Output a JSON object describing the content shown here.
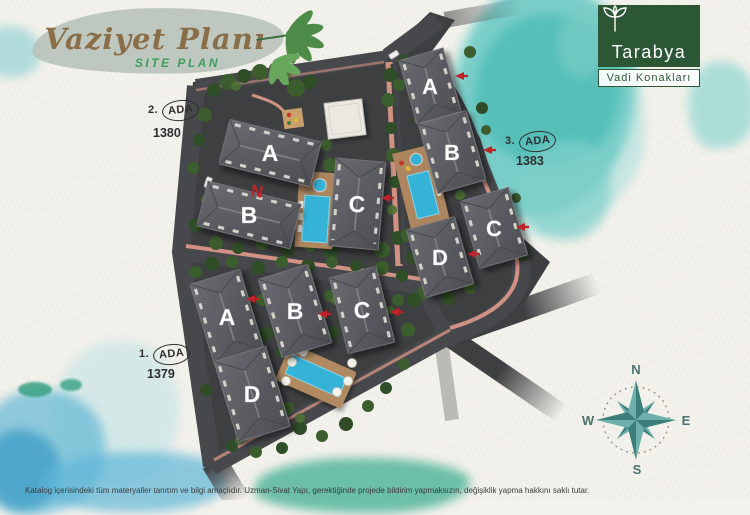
{
  "header": {
    "title": "Vaziyet Planı",
    "subtitle": "SITE PLAN"
  },
  "brand": {
    "name": "Tarabya",
    "tagline": "Vadi Konakları"
  },
  "site_plan": {
    "north_marker": "N",
    "blocks": [
      {
        "label_prefix": "2.",
        "label_circled": "ADA",
        "parcel": "1380",
        "buildings": [
          {
            "label": "A"
          },
          {
            "label": "B"
          },
          {
            "label": "C"
          }
        ]
      },
      {
        "label_prefix": "3.",
        "label_circled": "ADA",
        "parcel": "1383",
        "buildings": [
          {
            "label": "A"
          },
          {
            "label": "B"
          },
          {
            "label": "C"
          },
          {
            "label": "D"
          }
        ]
      },
      {
        "label_prefix": "1.",
        "label_circled": "ADA",
        "parcel": "1379",
        "buildings": [
          {
            "label": "A"
          },
          {
            "label": "B"
          },
          {
            "label": "C"
          },
          {
            "label": "D"
          }
        ]
      }
    ]
  },
  "compass": {
    "north": "N",
    "south": "S",
    "east": "E",
    "west": "W"
  },
  "footer": {
    "disclaimer": "Katalog içerisindeki tüm materyaller tanıtım ve bilgi amaçlıdır. Uzman-Sivat Yapı, gerektiğinde projede bildirim yapmaksızın, değişiklik yapma hakkını saklı tutar."
  },
  "colors": {
    "brand_green": "#2b5734",
    "title_brown": "#8a6e4a",
    "subtitle_green": "#3f9e5f",
    "watercolor_teal": "#4fbdb6",
    "roof_gray": "#55565c",
    "pool_blue": "#35b2d8",
    "road_gray": "#3e3f41",
    "marker_red": "#bf2328"
  }
}
